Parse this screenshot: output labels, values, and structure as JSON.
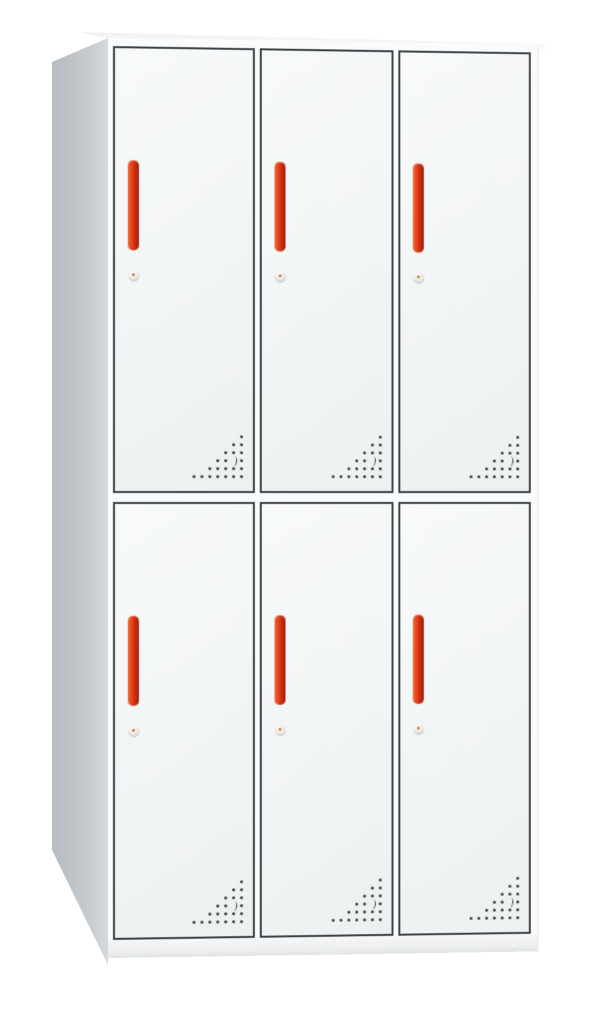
{
  "product": {
    "type": "six-door metal locker cabinet",
    "rows": 2,
    "columns": 3,
    "doors_total": 6
  },
  "cabinet": {
    "doors": [
      {
        "id": "door-1",
        "row": 1,
        "col": 1
      },
      {
        "id": "door-2",
        "row": 1,
        "col": 2
      },
      {
        "id": "door-3",
        "row": 1,
        "col": 3
      },
      {
        "id": "door-4",
        "row": 2,
        "col": 1
      },
      {
        "id": "door-5",
        "row": 2,
        "col": 2
      },
      {
        "id": "door-6",
        "row": 2,
        "col": 3
      }
    ],
    "per_door_parts": {
      "handle": "vertical bar handle",
      "lock": "round cam lock",
      "vent": "triangular perforation pattern with crescent slot"
    }
  },
  "colors": {
    "background": "#ffffff",
    "door_face": "#f2f4f5",
    "door_outline": "#3c4145",
    "side_panel": "#c4c9cd",
    "top_surface": "#f4f6f7",
    "base_panel": "#eceeef",
    "handle_orange": "#e8491c",
    "handle_red_dark": "#a02009",
    "lock_body": "#ece9e1",
    "lock_keyhole": "#bf7f3f",
    "vent_dot": "#3d3d3d"
  }
}
